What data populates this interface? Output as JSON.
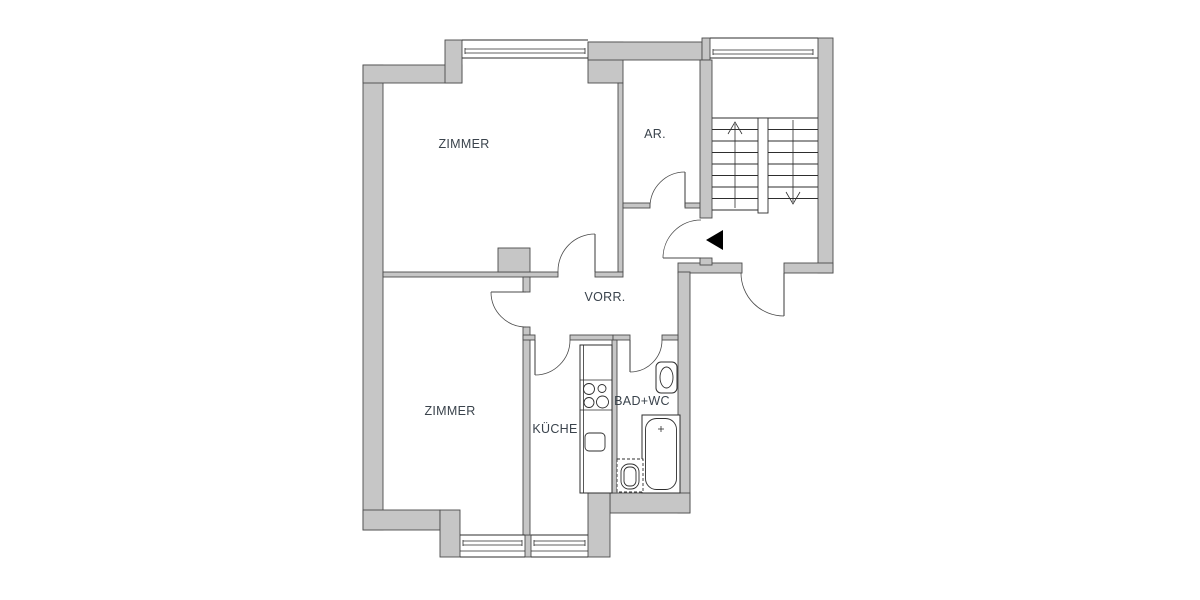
{
  "document": {
    "type": "apartment-floor-plan",
    "background": "#ffffff"
  },
  "floorplan": {
    "rooms": {
      "zimmer_top": {
        "label": "ZIMMER"
      },
      "abstellraum": {
        "label": "AR."
      },
      "vorraum": {
        "label": "VORR."
      },
      "zimmer_bottom": {
        "label": "ZIMMER"
      },
      "kueche": {
        "label": "KÜCHE"
      },
      "bad_wc": {
        "label": "BAD+WC"
      }
    },
    "staircase": {
      "flights": 2,
      "direction_markers": [
        "up",
        "down"
      ]
    },
    "entrance_marker": "black-triangle-pointing-left",
    "fixtures": [
      "bathtub",
      "toilet",
      "washbasin",
      "stove-4-burners",
      "kitchen-sink",
      "kitchen-counter"
    ],
    "windows": [
      "zimmer-top-window",
      "stairwell-window",
      "zimmer-bottom-window",
      "kueche-window"
    ],
    "doors": [
      "zimmer-top-door",
      "zimmer-bottom-door",
      "kueche-door",
      "bad-door",
      "ar-door",
      "apartment-entrance-door",
      "stair-landing-door"
    ],
    "colors": {
      "wall_fill": "#c6c6c6",
      "wall_outline": "#4b4b4b",
      "line": "#2e2e2e",
      "label_text": "#3a434c",
      "entrance_marker": "#000000",
      "background": "#ffffff"
    }
  }
}
